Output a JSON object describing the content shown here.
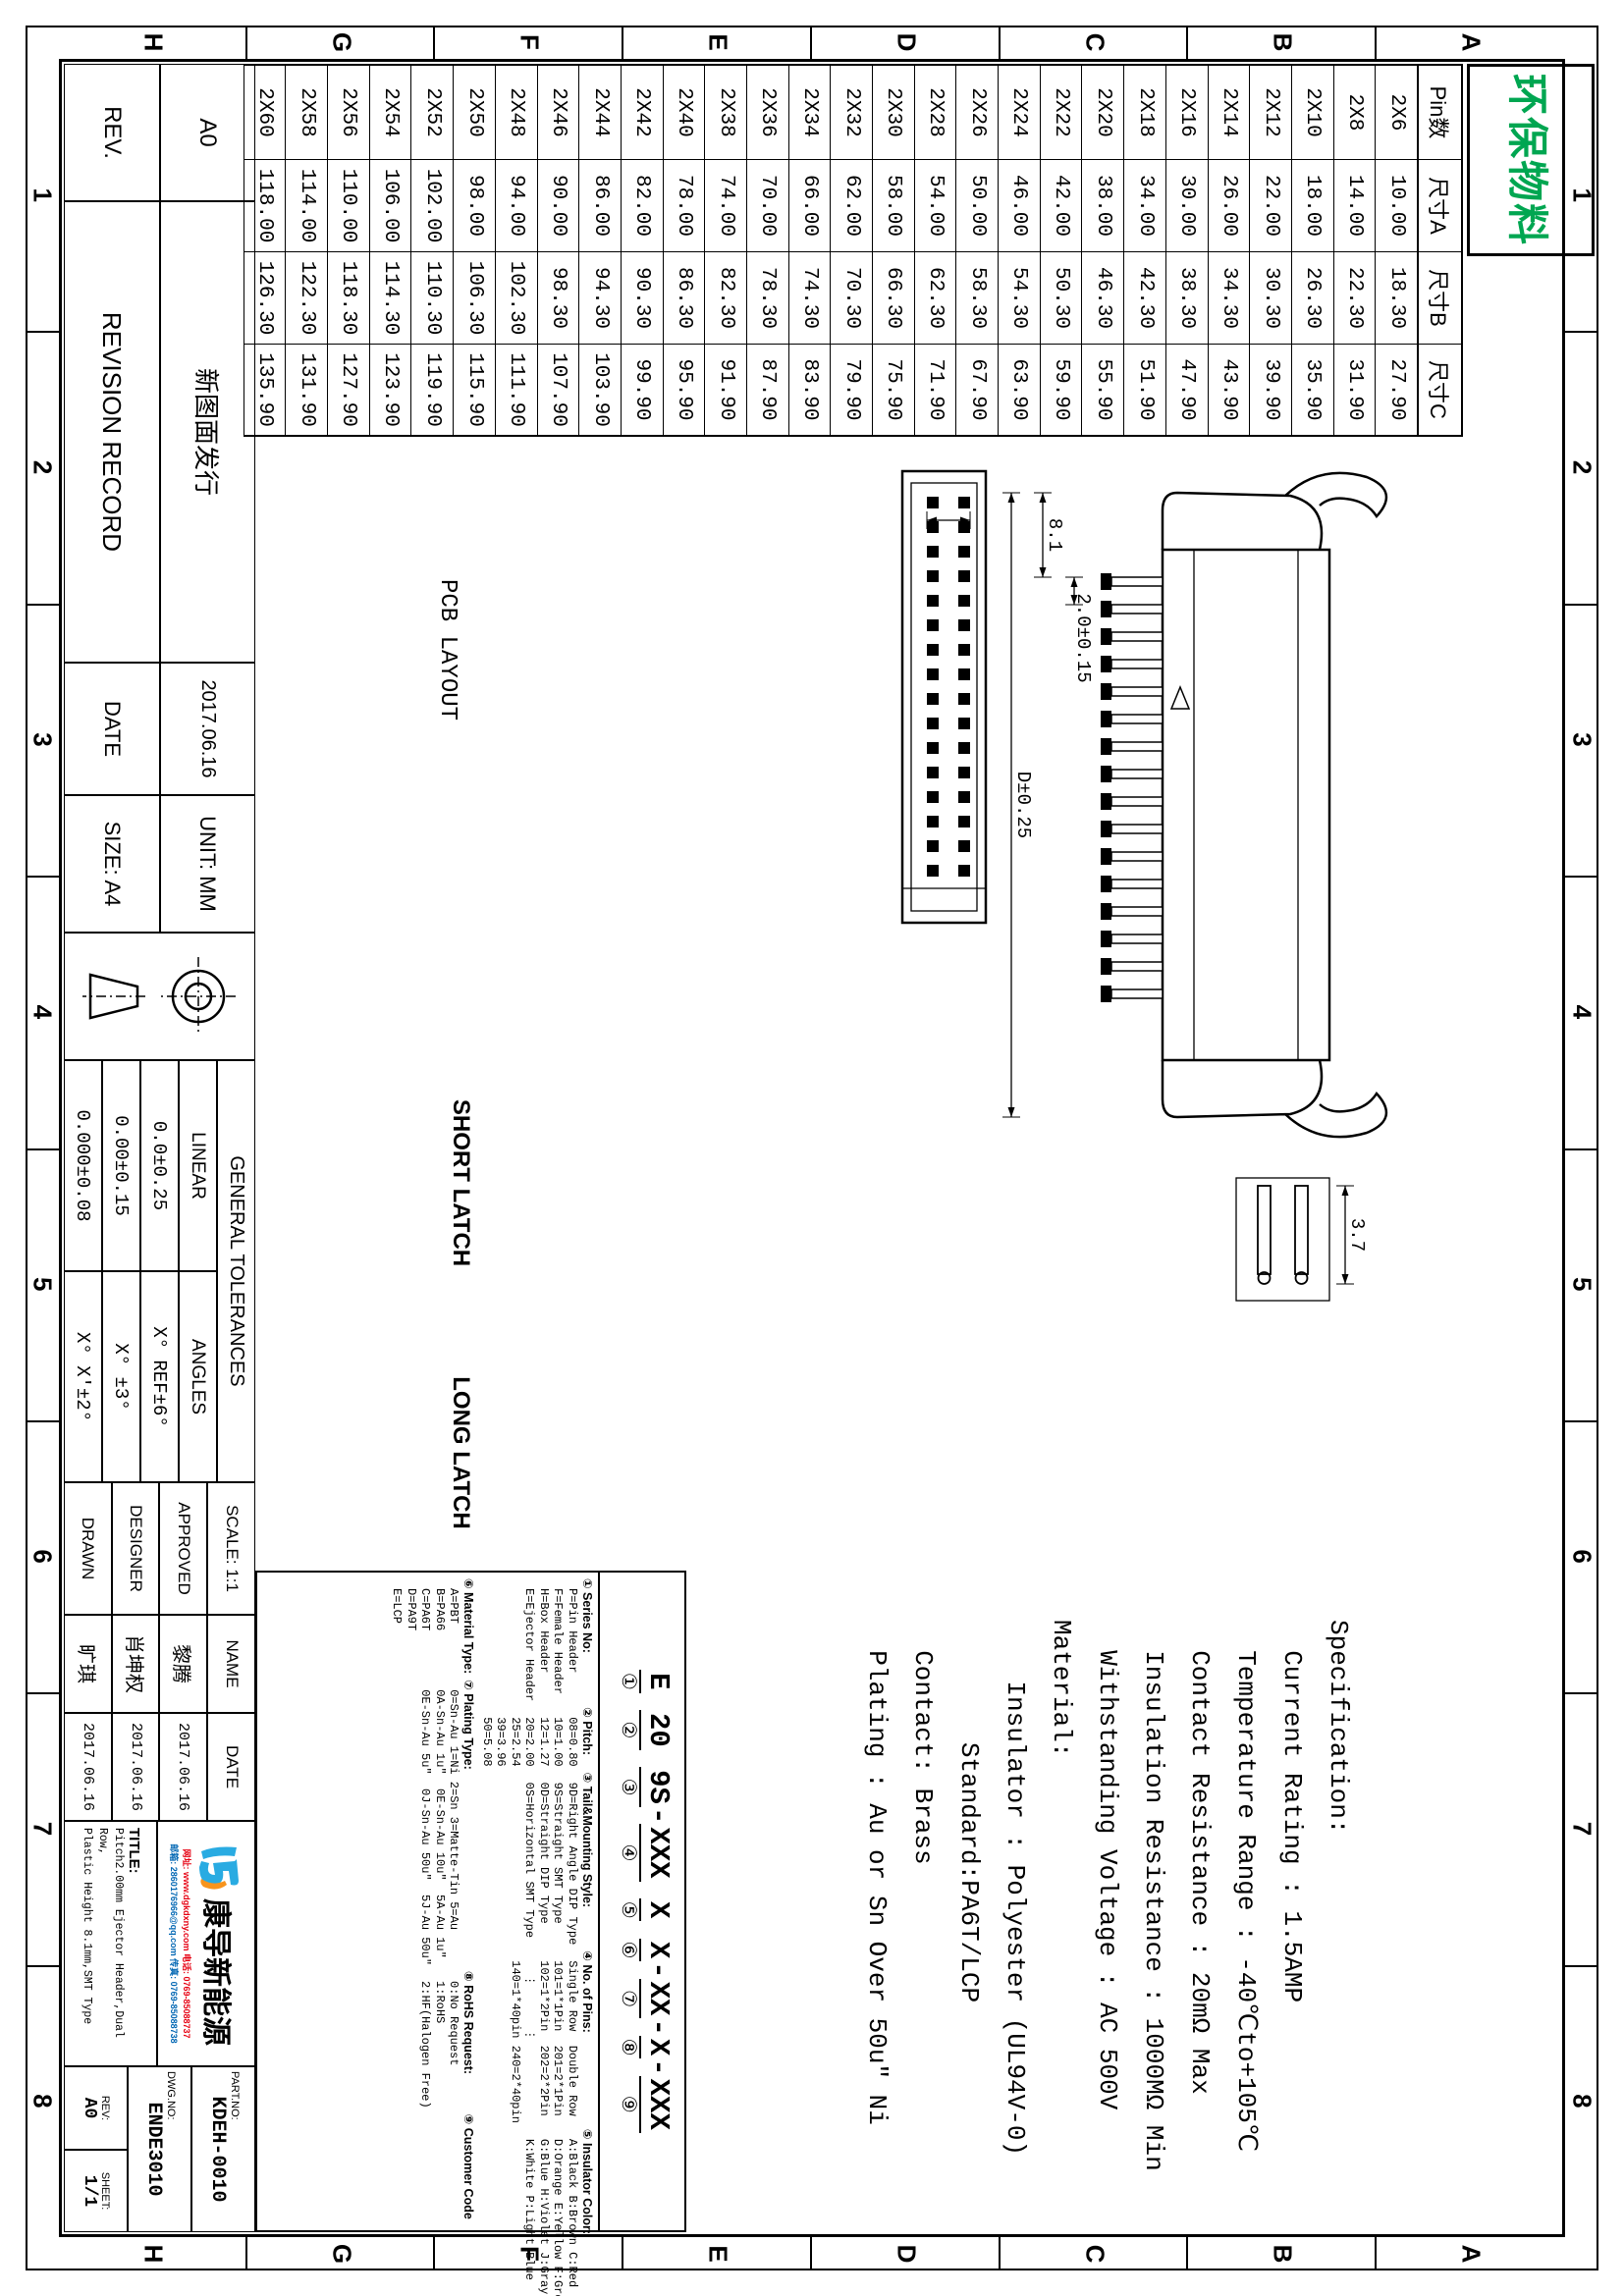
{
  "sheet": {
    "stamp": "环保物料",
    "frame_letters": [
      "A",
      "B",
      "C",
      "D",
      "E",
      "F",
      "G",
      "H"
    ],
    "frame_numbers": [
      "1",
      "2",
      "3",
      "4",
      "5",
      "6",
      "7",
      "8"
    ]
  },
  "colors": {
    "stamp_green": "#00a651",
    "logo_blue": "#29abe2",
    "logo_orange": "#f7941d",
    "contact_red": "#e60012",
    "contact_blue": "#0066b3",
    "line_black": "#000000"
  },
  "pin_table": {
    "headers": [
      "Pin数",
      "尺寸A",
      "尺寸B",
      "尺寸C"
    ],
    "rows": [
      [
        "2X6",
        "10.00",
        "18.30",
        "27.90"
      ],
      [
        "2X8",
        "14.00",
        "22.30",
        "31.90"
      ],
      [
        "2X10",
        "18.00",
        "26.30",
        "35.90"
      ],
      [
        "2X12",
        "22.00",
        "30.30",
        "39.90"
      ],
      [
        "2X14",
        "26.00",
        "34.30",
        "43.90"
      ],
      [
        "2X16",
        "30.00",
        "38.30",
        "47.90"
      ],
      [
        "2X18",
        "34.00",
        "42.30",
        "51.90"
      ],
      [
        "2X20",
        "38.00",
        "46.30",
        "55.90"
      ],
      [
        "2X22",
        "42.00",
        "50.30",
        "59.90"
      ],
      [
        "2X24",
        "46.00",
        "54.30",
        "63.90"
      ],
      [
        "2X26",
        "50.00",
        "58.30",
        "67.90"
      ],
      [
        "2X28",
        "54.00",
        "62.30",
        "71.90"
      ],
      [
        "2X30",
        "58.00",
        "66.30",
        "75.90"
      ],
      [
        "2X32",
        "62.00",
        "70.30",
        "79.90"
      ],
      [
        "2X34",
        "66.00",
        "74.30",
        "83.90"
      ],
      [
        "2X36",
        "70.00",
        "78.30",
        "87.90"
      ],
      [
        "2X38",
        "74.00",
        "82.30",
        "91.90"
      ],
      [
        "2X40",
        "78.00",
        "86.30",
        "95.90"
      ],
      [
        "2X42",
        "82.00",
        "90.30",
        "99.90"
      ],
      [
        "2X44",
        "86.00",
        "94.30",
        "103.90"
      ],
      [
        "2X46",
        "90.00",
        "98.30",
        "107.90"
      ],
      [
        "2X48",
        "94.00",
        "102.30",
        "111.90"
      ],
      [
        "2X50",
        "98.00",
        "106.30",
        "115.90"
      ],
      [
        "2X52",
        "102.00",
        "110.30",
        "119.90"
      ],
      [
        "2X54",
        "106.00",
        "114.30",
        "123.90"
      ],
      [
        "2X56",
        "110.00",
        "118.30",
        "127.90"
      ],
      [
        "2X58",
        "114.00",
        "122.30",
        "131.90"
      ],
      [
        "2X60",
        "118.00",
        "126.30",
        "135.90"
      ]
    ]
  },
  "views": {
    "pcb_label": "PCB LAYOUT",
    "short_latch_label": "SHORT LATCH",
    "long_latch_label": "LONG LATCH"
  },
  "dims": {
    "pcb_pad_w": "1.02",
    "pcb_pitch": "2",
    "pcb_span": "4.34",
    "pcb_gap": "9.65",
    "body_height": "5.95±0.2",
    "pin_pitch": "2.0±0.15",
    "key_width": "3.7",
    "latch_offset": "8.1",
    "body_span": "D±0.25",
    "end_w1": "4.8",
    "end_w2": "5.9",
    "end_w3": "5.1",
    "row_gap": "4.60",
    "span_a": "A±0.20",
    "span_b": "B±0.25",
    "span_c": "C±0.25",
    "pin_sq": "SQ 0.60",
    "section_h": "8.9±0.25",
    "short_d1": "8.1",
    "short_d2": "4.9",
    "long_d1": "8.1",
    "long_d2": "8.95"
  },
  "spec": {
    "lines": [
      "Specification:",
      "  Current Rating : 1.5AMP",
      "  Temperature Range : -40℃to+105℃",
      "  Contact Resistance : 20mΩ Max",
      "  Insulation Resistance : 1000MΩ Min",
      "  Withstanding Voltage : AC 500V",
      "Material:",
      "    Insulator : Polyester (UL94V-0)",
      "        Standard:PA6T/LCP",
      "  Contact: Brass",
      "  Plating : Au or Sn Over 50u\" Ni"
    ]
  },
  "ordering": {
    "segments": [
      {
        "pre": "",
        "code": "E",
        "num": "①"
      },
      {
        "pre": " ",
        "code": "20",
        "num": "②"
      },
      {
        "pre": " ",
        "code": "9S",
        "num": "③"
      },
      {
        "pre": "-",
        "code": "XXX",
        "num": "④"
      },
      {
        "pre": " ",
        "code": "X",
        "num": "⑤"
      },
      {
        "pre": " ",
        "code": "X",
        "num": "⑥"
      },
      {
        "pre": "-",
        "code": "XX",
        "num": "⑦"
      },
      {
        "pre": "-",
        "code": "X",
        "num": "⑧"
      },
      {
        "pre": "-",
        "code": "XXX",
        "num": "⑨"
      }
    ],
    "sections_top": [
      {
        "title": "① Series No:",
        "items": [
          "P=Pin Header",
          "F=Female Header",
          "H=Box Header",
          "E=Ejector Header"
        ]
      },
      {
        "title": "② Pitch:",
        "items": [
          "08=0.80",
          "10=1.00",
          "12=1.27",
          "20=2.00",
          "25=2.54",
          "39=3.96",
          "50=5.08"
        ]
      },
      {
        "title": "③ Tail&Mounting Style:",
        "items": [
          "9D=Right Angle DIP Type",
          "9S=Straight SMT Type",
          "0D=Straight DIP Type",
          "0S=Horizontal SMT Type"
        ]
      },
      {
        "title": "④ No. of Pins:",
        "items": [
          "Single Row  Double Row",
          "101=1*1Pin  201=2*1Pin",
          "102=1*2Pin  202=2*2Pin",
          "  ⋮      ⋮",
          "140=1*40pin 240=2*40pin"
        ]
      },
      {
        "title": "⑤ Insulator Color:",
        "items": [
          "A:Black B:Brown C:Red",
          "D:Orange E:Yellow F:Green",
          "G:Blue H:Violet J:Gray",
          "K:White P:Light Blue"
        ]
      }
    ],
    "sections_bottom": [
      {
        "title": "⑥ Material Type:",
        "items": [
          "A=PBT",
          "B=PA66",
          "C=PA6T",
          "D=PA9T",
          "E=LCP"
        ]
      },
      {
        "title": "⑦ Plating Type:",
        "items": [
          "0=Sn-Au 1=Ni 2=Sn 3=Matte-Tin 5=Au",
          "0A-Sn-Au 1u\"  0E-Sn-Au 10u\"  5A-Au 1u\"",
          "0E-Sn-Au 5u\"  0J-Sn-Au 50u\"  5J-Au 50u\""
        ]
      },
      {
        "title": "⑧ RoHS Request:",
        "items": [
          "0:No Request",
          "1:RoHS",
          "2:HF(Halogen Free)"
        ]
      },
      {
        "title": "⑨ Customer Code",
        "items": []
      }
    ]
  },
  "titleblock": {
    "revision": {
      "entry_rev": "A0",
      "entry_desc": "新图面发行",
      "entry_date": "2017.06.16",
      "rev_label": "REV.",
      "record_label": "REVISION RECORD",
      "date_label": "DATE"
    },
    "unit": "UNIT: MM",
    "size": "SIZE: A4",
    "tolerances": {
      "header": "GENERAL TOLERANCES",
      "linear_label": "LINEAR",
      "angles_label": "ANGLES",
      "linear": [
        "0.0±0.25",
        "0.00±0.15",
        "0.000±0.08"
      ],
      "angles": [
        "X° REF±6°",
        "X° ±3°",
        "X° X'±2°"
      ]
    },
    "staff": {
      "scale_label": "SCALE:",
      "scale": "1:1",
      "name_label": "NAME",
      "date_label": "DATE",
      "rows": [
        {
          "role": "APPROVED",
          "name": "黎腾",
          "date": "2017.06.16"
        },
        {
          "role": "DESIGNER",
          "name": "肖坤权",
          "date": "2017.06.16"
        },
        {
          "role": "DRAWN",
          "name": "旷琪",
          "date": "2017.06.16"
        }
      ]
    },
    "company": {
      "name": "康导新能源",
      "contact1": "网址: www.dgkdxny.com 电话: 0769-85088737",
      "contact2": "邮箱: 2860176966@qq.com 传真: 0769-85088738"
    },
    "title_label": "TITLE:",
    "title_lines": [
      "Pitch2.00mm Ejector Header,Dual Row,",
      "Plastic Height 8.1mm,SMT Type"
    ],
    "partno_label": "PART.NO:",
    "partno": "KDEH-0010",
    "dwg_label": "DWG.NO:",
    "dwg": "ENDE3010",
    "rev_label": "REV:",
    "rev": "A0",
    "sheet_label": "SHEET:",
    "sheet": "1/1"
  }
}
